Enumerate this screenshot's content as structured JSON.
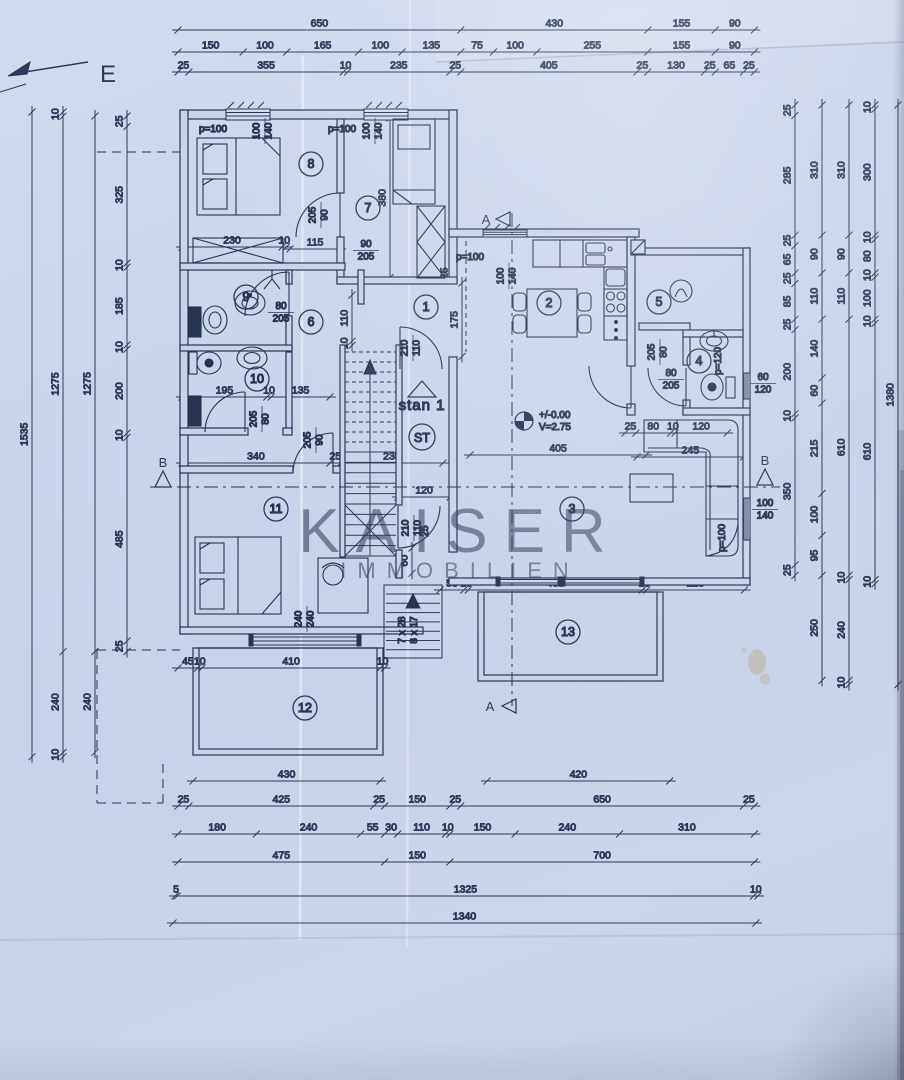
{
  "compass": {
    "label": "E"
  },
  "watermark": {
    "line1": "KAISER",
    "line2": "IMMOBILIEN"
  },
  "apartment": {
    "name": "stan 1",
    "staircase_label": "ST",
    "elevation_level": "+/-0.00",
    "elevation_height": "V=2.75"
  },
  "sections": {
    "a": "A",
    "b": "B"
  },
  "rooms": [
    "1",
    "2",
    "3",
    "4",
    "5",
    "6",
    "7",
    "8",
    "9",
    "10",
    "11",
    "12",
    "13"
  ],
  "labels": {
    "p100_room8": "p=100",
    "size_room8_w": "100",
    "size_room8_h": "140",
    "p100_room7": "p=100",
    "size_room7_w": "100",
    "size_room7_h": "140",
    "p100_kitchen": "p=100",
    "size_kitchen_w": "100",
    "size_kitchen_h": "140",
    "p100_living": "p=100",
    "size_living_w": "100",
    "size_living_h": "140",
    "p120_bath4": "p=120",
    "size_bath4_w": "60",
    "size_bath4_h": "120",
    "size_room11_w": "240",
    "size_room11_h": "240",
    "door8_a": "205",
    "door8_b": "90",
    "door8_c": "90",
    "door8_d": "205",
    "door6_a": "80",
    "door6_b": "205",
    "door10_a": "205",
    "door10_b": "80",
    "door1_a": "210",
    "door1_b": "110",
    "doorc4_a": "205",
    "doorc4_b": "80",
    "door4_a": "80",
    "door4_b": "205",
    "entry_a": "210",
    "entry_b": "110",
    "entry_c": "25",
    "door11_a": "205",
    "door11_b": "90",
    "stair_run1": "7 x 28",
    "stair_run2": "8 x 17"
  },
  "dims": {
    "top": {
      "row1": [
        "650",
        "430",
        "155",
        "90"
      ],
      "row2": [
        "150",
        "100",
        "165",
        "100",
        "135",
        "75",
        "100",
        "255",
        "155",
        "90"
      ],
      "row3": [
        "25",
        "355",
        "10",
        "235",
        "25",
        "405",
        "25",
        "130",
        "25",
        "65",
        "25"
      ]
    },
    "bottom": {
      "terrace12": [
        "430"
      ],
      "terrace13": [
        "420"
      ],
      "row1": [
        "25",
        "425",
        "25",
        "150",
        "25",
        "650",
        "25"
      ],
      "row2": [
        "180",
        "240",
        "55",
        "30",
        "110",
        "10",
        "150",
        "240",
        "310"
      ],
      "row3": [
        "475",
        "150",
        "700"
      ],
      "row4": [
        "5",
        "1325",
        "10"
      ],
      "row5": [
        "1340"
      ]
    },
    "left": {
      "chain1": [
        "1535"
      ],
      "chain2": [
        "10",
        "1275",
        "240",
        "10"
      ],
      "chain3": [
        "1275",
        "240"
      ],
      "chain4": [
        "25",
        "325",
        "10",
        "185",
        "10",
        "200",
        "10",
        "485",
        "25"
      ]
    },
    "right": {
      "chain1": [
        "25",
        "285",
        "25",
        "65",
        "25",
        "85",
        "25",
        "200",
        "10",
        "350",
        "25"
      ],
      "chain2": [
        "310",
        "90",
        "110",
        "140",
        "60",
        "215",
        "100",
        "95",
        "250"
      ],
      "chain3": [
        "310",
        "90",
        "110",
        "610",
        "10",
        "240",
        "10"
      ],
      "chain4": [
        "10",
        "300",
        "10",
        "80",
        "10",
        "100",
        "10",
        "610",
        "10"
      ],
      "chain5": [
        "1380"
      ]
    },
    "interior": {
      "closet_row": [
        "230",
        "10"
      ],
      "door8_width": [
        "115"
      ],
      "bath10_row": [
        "195",
        "10",
        "135"
      ],
      "room11_row": [
        "340",
        "25",
        "235"
      ],
      "corridor_120": [
        "120"
      ],
      "living_405": [
        "405"
      ],
      "sofa_row": [
        "25",
        "80",
        "10",
        "120"
      ],
      "sofa_245": [
        "245"
      ],
      "terrace13_row": [
        "55",
        "10",
        "400",
        "10",
        "225"
      ],
      "terrace12_row": [
        "45",
        "10",
        "410",
        "10"
      ],
      "room7_depth": [
        "380"
      ],
      "opening_175": [
        "175"
      ],
      "wall_110": [
        "110",
        "10"
      ],
      "wall_25": [
        "25"
      ],
      "stairs_60": [
        "60"
      ]
    }
  }
}
